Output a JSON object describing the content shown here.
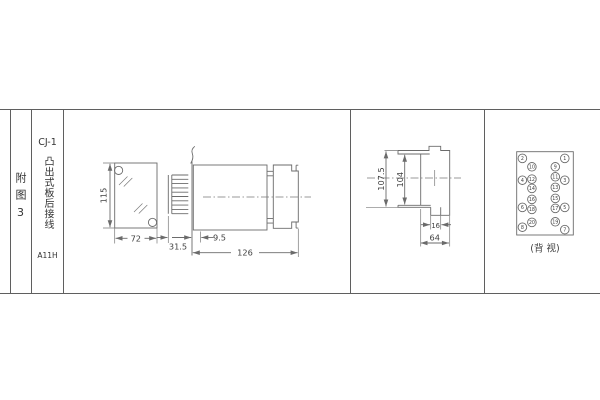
{
  "colors": {
    "line": "#6b6b6b",
    "frame": "#5f5f5f",
    "text": "#3f3f3f",
    "background": "#ffffff"
  },
  "title_block": {
    "figure_label": "附图3",
    "model": "CJ-1",
    "mount_type": "凸出式板后接线",
    "code": "A11H"
  },
  "front_view": {
    "height_dim": "115",
    "width_dim": "72"
  },
  "side_view": {
    "front_depth_dim": "31.5",
    "flange_dim": "9.5",
    "body_depth_dim": "126"
  },
  "rear_view": {
    "outer_height_dim": "107.5",
    "inner_height_dim": "104",
    "stud_width_dim": "16",
    "body_width_dim": "64"
  },
  "back_view": {
    "label": "(背 视)",
    "pins": {
      "left_outer": [
        "2",
        "4",
        "6",
        "8"
      ],
      "left_inner": [
        "10",
        "12",
        "14",
        "16",
        "18",
        "20"
      ],
      "right_inner": [
        "9",
        "11",
        "13",
        "15",
        "17",
        "19"
      ],
      "right_outer": [
        "1",
        "3",
        "5",
        "7"
      ]
    }
  }
}
